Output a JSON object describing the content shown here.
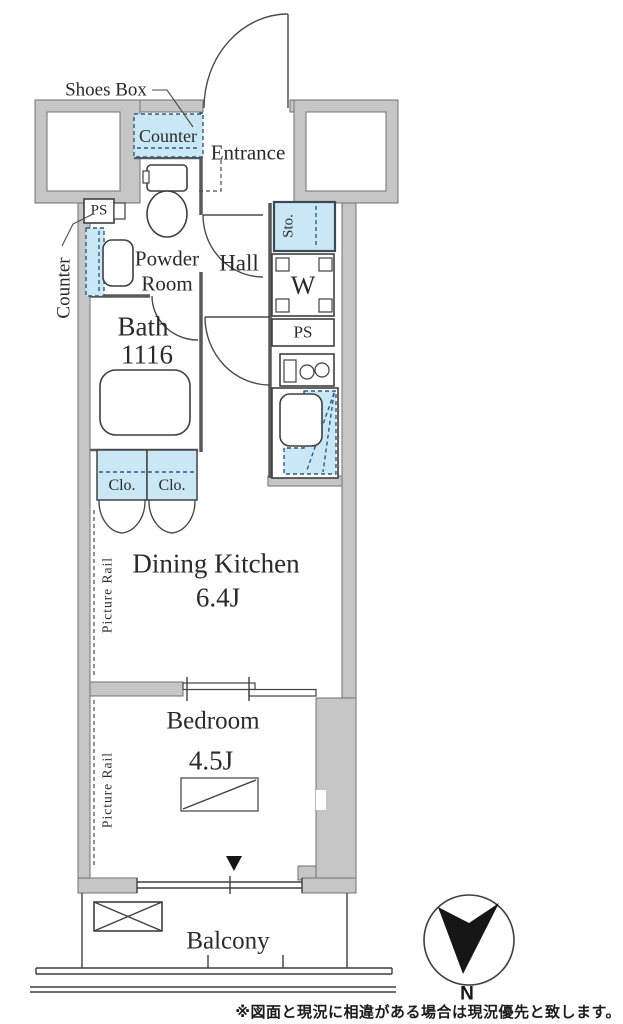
{
  "plan": {
    "labels": {
      "shoes_box": "Shoes Box",
      "shoe_counter": "Counter",
      "entrance": "Entrance",
      "ps_left": "PS",
      "counter_left": "Counter",
      "powder_room_line1": "Powder",
      "powder_room_line2": "Room",
      "hall": "Hall",
      "storage": "Sto.",
      "washer": "W",
      "ps_right": "PS",
      "bath": "Bath",
      "bath_size": "1116",
      "closet1": "Clo.",
      "closet2": "Clo.",
      "dining_kitchen": "Dining Kitchen",
      "dining_kitchen_size": "6.4J",
      "picture_rail_dk": "Picture Rail",
      "bedroom": "Bedroom",
      "bedroom_size": "4.5J",
      "picture_rail_bedroom": "Picture Rail",
      "balcony": "Balcony"
    },
    "compass": {
      "north": "N"
    },
    "note": "※図面と現況に相違がある場合は現況優先と致します。",
    "colors": {
      "wall_gray": "#c6c6c6",
      "fixture_blue": "#c9e7f5",
      "dash_navy": "#2b5d80",
      "line": "#3f3f3f"
    }
  }
}
